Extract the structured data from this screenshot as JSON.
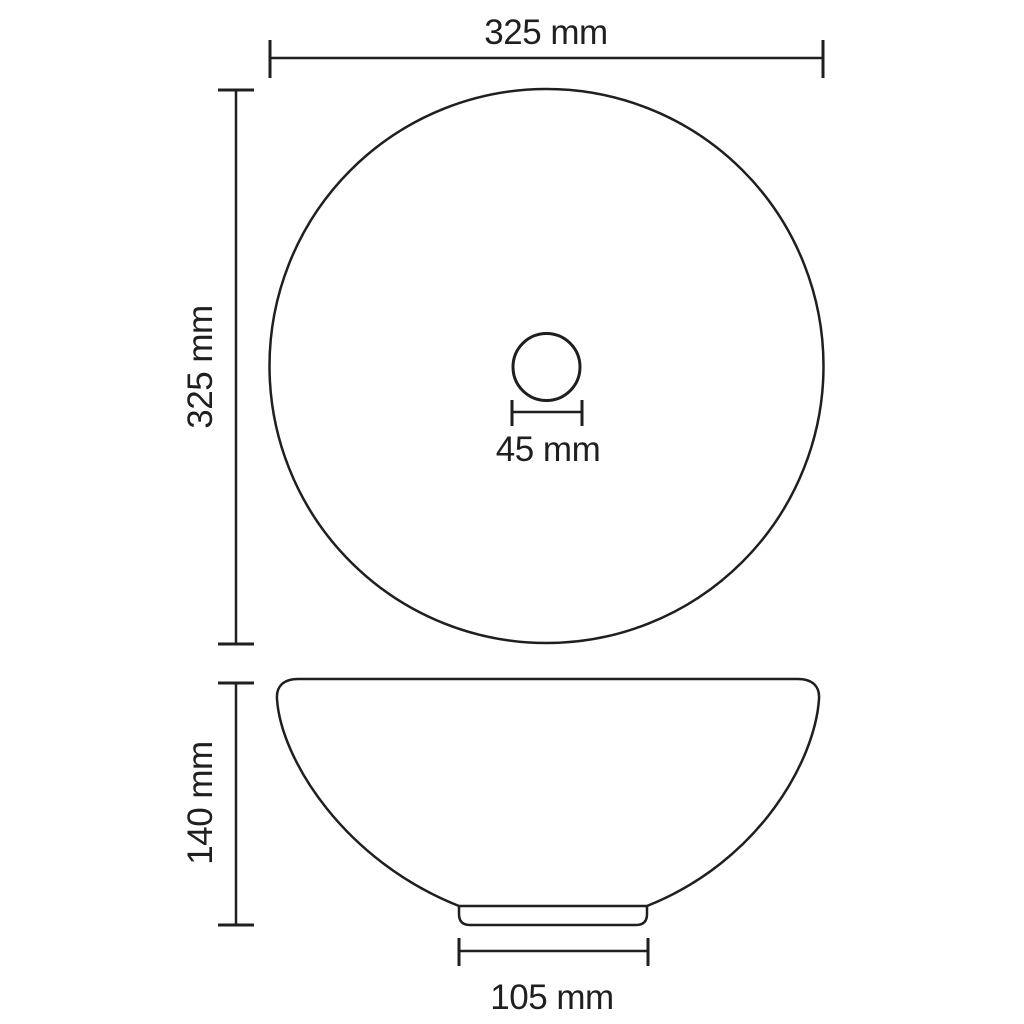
{
  "colors": {
    "ink": "#1f1f1f",
    "background": "#ffffff"
  },
  "dimensions": {
    "top_width": "325 mm",
    "left_height": "325 mm",
    "drain": "45 mm",
    "side_height": "140 mm",
    "base_width": "105 mm"
  }
}
